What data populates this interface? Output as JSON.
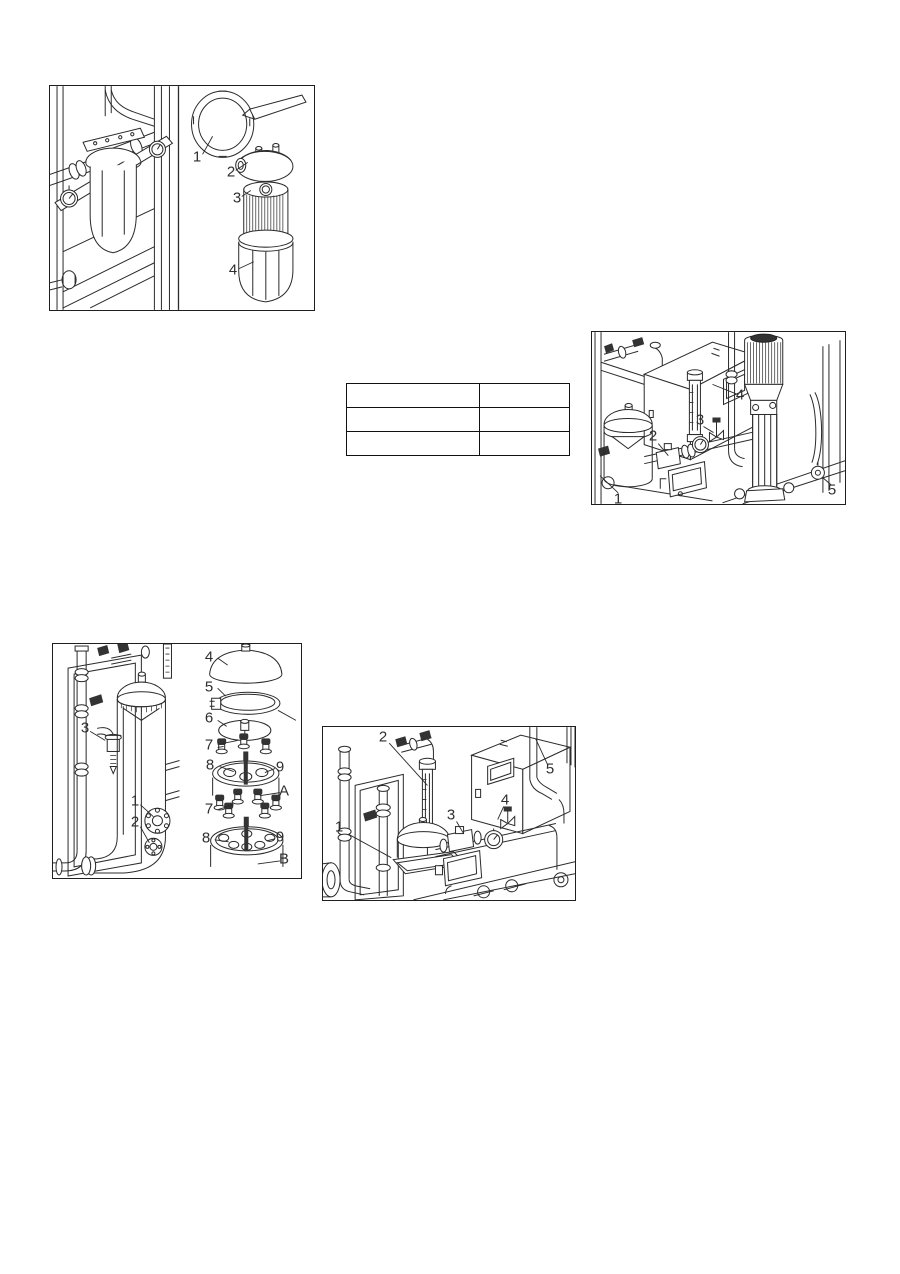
{
  "page": {
    "background": "#ffffff",
    "line_color": "#2b2b2b",
    "figure_border_color": "#1f1f1f",
    "table_border_color": "#111111",
    "callout_text_color": "#2e2e2e"
  },
  "figures": {
    "filter": {
      "callouts": [
        "1",
        "2",
        "3",
        "4"
      ]
    },
    "pump": {
      "callouts": [
        "1",
        "2",
        "3",
        "4",
        "5"
      ]
    },
    "vessel": {
      "callouts": [
        "3",
        "1",
        "2",
        "4",
        "5",
        "6",
        "7",
        "8",
        "9",
        "A",
        "7",
        "8",
        "9",
        "B"
      ]
    },
    "front": {
      "callouts": [
        "1",
        "2",
        "3",
        "4",
        "5"
      ]
    }
  },
  "table": {
    "rows": [
      [
        "",
        ""
      ],
      [
        "",
        ""
      ],
      [
        "",
        ""
      ]
    ]
  }
}
